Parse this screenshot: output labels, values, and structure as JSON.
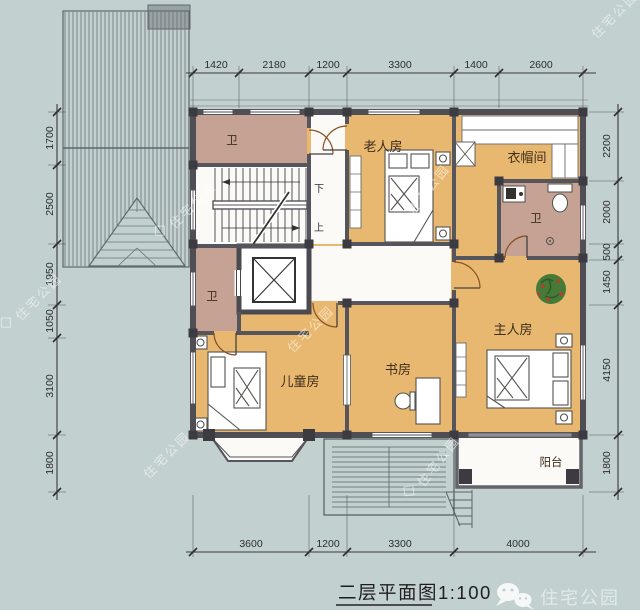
{
  "title": {
    "text": "二层平面图",
    "scale": "1:100"
  },
  "rooms": {
    "bath_top": "卫",
    "bath_small": "卫",
    "bath_master": "卫",
    "elder": "老人房",
    "cloak": "衣帽间",
    "master": "主人房",
    "kids": "儿童房",
    "study": "书房",
    "balcony": "阳台"
  },
  "stairs": {
    "down": "下",
    "up": "上"
  },
  "dims": {
    "top": [
      "1420",
      "2180",
      "1200",
      "3300",
      "1400",
      "2600"
    ],
    "bottom": [
      "3600",
      "1200",
      "3300",
      "4000"
    ],
    "left": [
      "1700",
      "2500",
      "1950",
      "1050",
      "3100",
      "1800"
    ],
    "right": [
      "2200",
      "2000",
      "500",
      "1450",
      "4150",
      "1800"
    ]
  },
  "branding": {
    "name": "住宅公园"
  },
  "watermark": {
    "text": "住宅公园"
  },
  "colors": {
    "background": "#c2d0cf",
    "floor": "#e9b870",
    "bath_floor": "#c6a294",
    "wall": "#4e4e54",
    "plant": "#467a38"
  }
}
